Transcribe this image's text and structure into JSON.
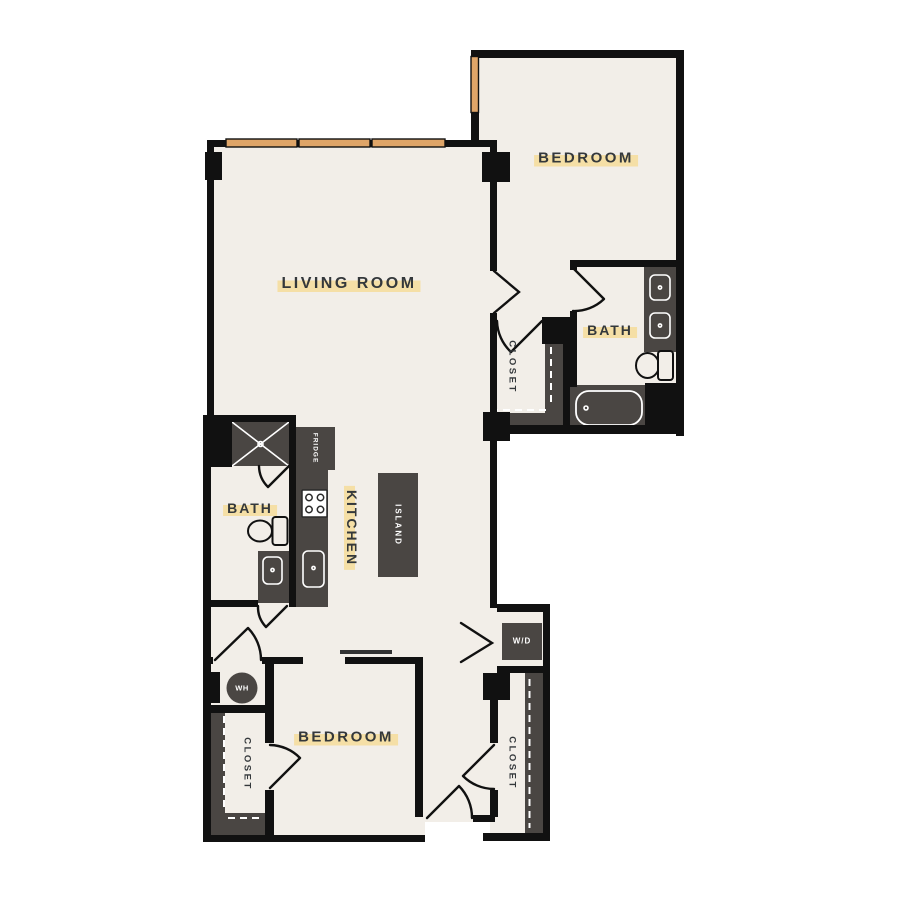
{
  "floor_plan": {
    "labels": {
      "living_room": "LIVING ROOM",
      "bedroom_top": "BEDROOM",
      "bedroom_bottom": "BEDROOM",
      "bath_right": "BATH",
      "bath_left": "BATH",
      "kitchen": "KITCHEN",
      "closet_mid": "CLOSET",
      "closet_bottom_left": "CLOSET",
      "closet_bottom_right": "CLOSET",
      "island": "ISLAND",
      "fridge": "FRIDGE",
      "washer_dryer": "W/D",
      "water_heater": "WH"
    },
    "colors": {
      "wall": "#111111",
      "floor": "#f2eee8",
      "fixture": "#4a4643",
      "window_tan": "#dfa568",
      "label_highlight": "#f5dfa6",
      "label_text": "#34383b",
      "background": "#ffffff"
    }
  }
}
